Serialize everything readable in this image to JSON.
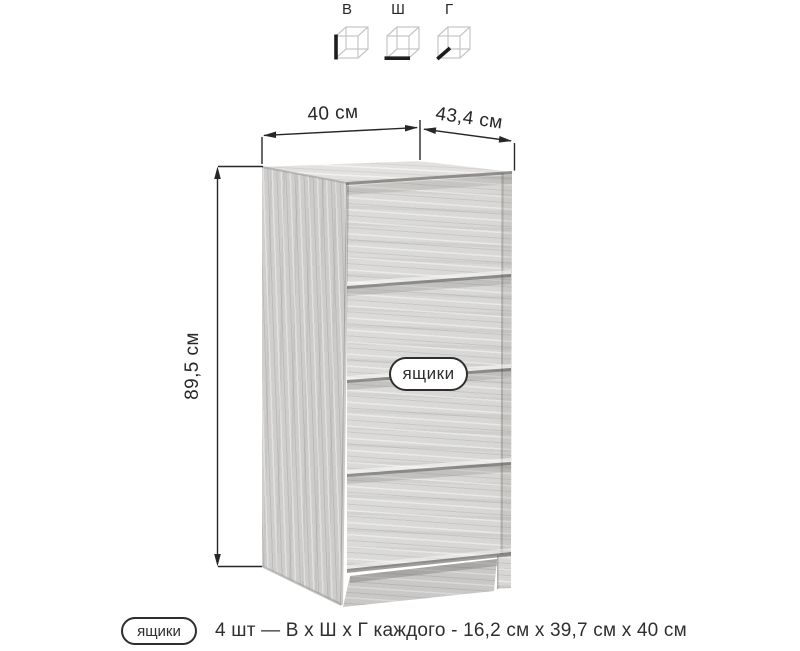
{
  "page": {
    "background": "#ffffff"
  },
  "size_legend": {
    "items": [
      {
        "label": "В",
        "icon": "cube-height-icon"
      },
      {
        "label": "Ш",
        "icon": "cube-width-icon"
      },
      {
        "label": "Г",
        "icon": "cube-depth-icon"
      }
    ]
  },
  "dimensions": {
    "width": "40 см",
    "depth": "43,4 см",
    "height": "89,5 см"
  },
  "cabinet": {
    "type": "chest-of-4-drawers",
    "drawers_tag": "ящики"
  },
  "footer": {
    "tag": "ящики",
    "description": "4 шт — В х Ш х Г каждого - 16,2 см х 39,7 см х 40 см"
  },
  "colors": {
    "line": "#272727",
    "wood_top": "#e2e1df",
    "wood_front": "#d9d8d6",
    "wood_side": "#d0cfcd"
  }
}
